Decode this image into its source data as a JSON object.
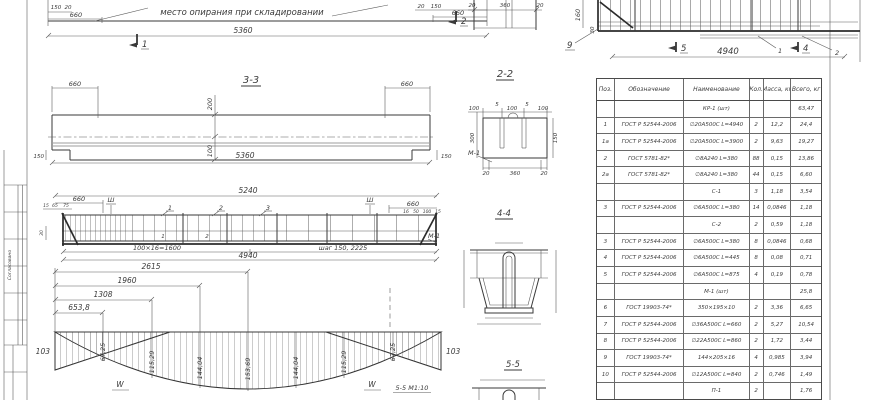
{
  "plan": {
    "note": "место опирания при складировании",
    "d150": "150",
    "d20": "20",
    "d660_left": "660",
    "d20_right": "20",
    "d150_right": "150",
    "d660_right": "660",
    "d_total": "5360",
    "mark1": "1",
    "mark2": "2"
  },
  "end_section": {
    "d20a": "20",
    "d360": "360",
    "d20b": "20"
  },
  "cage": {
    "d160": "160",
    "d30": "30",
    "d_total": "4940",
    "pos9": "9",
    "mark5": "5",
    "mark4": "4",
    "callout1": "1",
    "callout2": "2"
  },
  "s33": {
    "title": "3-3",
    "d660_left": "660",
    "d660_right": "660",
    "d200": "200",
    "d100": "100",
    "d_total": "5360",
    "d150_left": "150",
    "d150_right": "150"
  },
  "s22": {
    "title": "2-2",
    "d100a": "100",
    "d5a": "5",
    "d100b": "100",
    "d5b": "5",
    "d100c": "100",
    "d300": "300",
    "d150": "150",
    "m1": "М-1",
    "d20a": "20",
    "d360": "360",
    "d20b": "20"
  },
  "reinf": {
    "d5240": "5240",
    "d660_left": "660",
    "sh_left": "Ш",
    "c1": "1",
    "c2": "2",
    "c3": "3",
    "d15": "15",
    "d65": "65",
    "d75": "75",
    "d30": "30",
    "sh_right": "Ш",
    "d660_right": "660",
    "d16": "16",
    "d50": "50",
    "d100": "100",
    "d15b": "15",
    "bar1": "1",
    "bar2": "2",
    "m1": "М-1",
    "seg1": "100×16=1600",
    "seg2": "шаг 150, 2225",
    "d4940": "4940"
  },
  "moment": {
    "d2615": "2615",
    "d1960": "1960",
    "d1308": "1308",
    "d653": "653,8",
    "left103": "103",
    "right103": "103",
    "v1": "67,25",
    "v2": "115,29",
    "v3": "144,04",
    "v4": "153,69",
    "v5": "144,04",
    "v6": "115,29",
    "v7": "67,25",
    "w": "W",
    "note": "5-5 М1:10"
  },
  "s44": {
    "title": "4-4"
  },
  "s55": {
    "title": "5-5"
  },
  "strip": {
    "approve": "Согласовано"
  },
  "spec": {
    "headers": [
      "Поз.",
      "Обозначение",
      "Наименование",
      "Кол.",
      "Масса, кг",
      "Всего, кг"
    ],
    "rows": [
      {
        "group": true,
        "pos": "",
        "doc": "",
        "name": "КР-1 (шт)",
        "qty": "",
        "mass": "",
        "total": "63,47"
      },
      {
        "group": false,
        "pos": "1",
        "doc": "ГОСТ Р 52544-2006",
        "name": "∅20А500С  L=4940",
        "qty": "2",
        "mass": "12,2",
        "total": "24,4"
      },
      {
        "group": false,
        "pos": "1а",
        "doc": "ГОСТ Р 52544-2006",
        "name": "∅20А500С  L=3900",
        "qty": "2",
        "mass": "9,63",
        "total": "19,27"
      },
      {
        "group": false,
        "pos": "2",
        "doc": "ГОСТ 5781-82*",
        "name": "∅8А240  L=380",
        "qty": "88",
        "mass": "0,15",
        "total": "13,86"
      },
      {
        "group": false,
        "pos": "2а",
        "doc": "ГОСТ 5781-82*",
        "name": "∅8А240  L=380",
        "qty": "44",
        "mass": "0,15",
        "total": "6,60"
      },
      {
        "group": true,
        "pos": "",
        "doc": "",
        "name": "С-1",
        "qty": "3",
        "mass": "1,18",
        "total": "3,54"
      },
      {
        "group": false,
        "pos": "3",
        "doc": "ГОСТ Р 52544-2006",
        "name": "∅6А500С  L=380",
        "qty": "14",
        "mass": "0,0846",
        "total": "1,18"
      },
      {
        "group": true,
        "pos": "",
        "doc": "",
        "name": "С-2",
        "qty": "2",
        "mass": "0,59",
        "total": "1,18"
      },
      {
        "group": false,
        "pos": "3",
        "doc": "ГОСТ Р 52544-2006",
        "name": "∅6А500С  L=380",
        "qty": "8",
        "mass": "0,0846",
        "total": "0,68"
      },
      {
        "group": false,
        "pos": "4",
        "doc": "ГОСТ Р 52544-2006",
        "name": "∅6А500С  L=445",
        "qty": "8",
        "mass": "0,08",
        "total": "0,71"
      },
      {
        "group": false,
        "pos": "5",
        "doc": "ГОСТ Р 52544-2006",
        "name": "∅6А500С  L=875",
        "qty": "4",
        "mass": "0,19",
        "total": "0,78"
      },
      {
        "group": true,
        "pos": "",
        "doc": "",
        "name": "М-1 (шт)",
        "qty": "",
        "mass": "",
        "total": "25,8"
      },
      {
        "group": false,
        "pos": "6",
        "doc": "ГОСТ 19903-74*",
        "name": "350×195×10",
        "qty": "2",
        "mass": "3,36",
        "total": "6,65"
      },
      {
        "group": false,
        "pos": "7",
        "doc": "ГОСТ Р 52544-2006",
        "name": "∅36А500С  L=660",
        "qty": "2",
        "mass": "5,27",
        "total": "10,54"
      },
      {
        "group": false,
        "pos": "8",
        "doc": "ГОСТ Р 52544-2006",
        "name": "∅22А500С  L=860",
        "qty": "2",
        "mass": "1,72",
        "total": "3,44"
      },
      {
        "group": false,
        "pos": "9",
        "doc": "ГОСТ 19903-74*",
        "name": "144×205×16",
        "qty": "4",
        "mass": "0,985",
        "total": "3,94"
      },
      {
        "group": false,
        "pos": "10",
        "doc": "ГОСТ Р 52544-2006",
        "name": "∅12А500С  L=840",
        "qty": "2",
        "mass": "0,746",
        "total": "1,49"
      },
      {
        "group": true,
        "pos": "",
        "doc": "",
        "name": "П-1",
        "qty": "2",
        "mass": "",
        "total": "1,76"
      }
    ]
  }
}
